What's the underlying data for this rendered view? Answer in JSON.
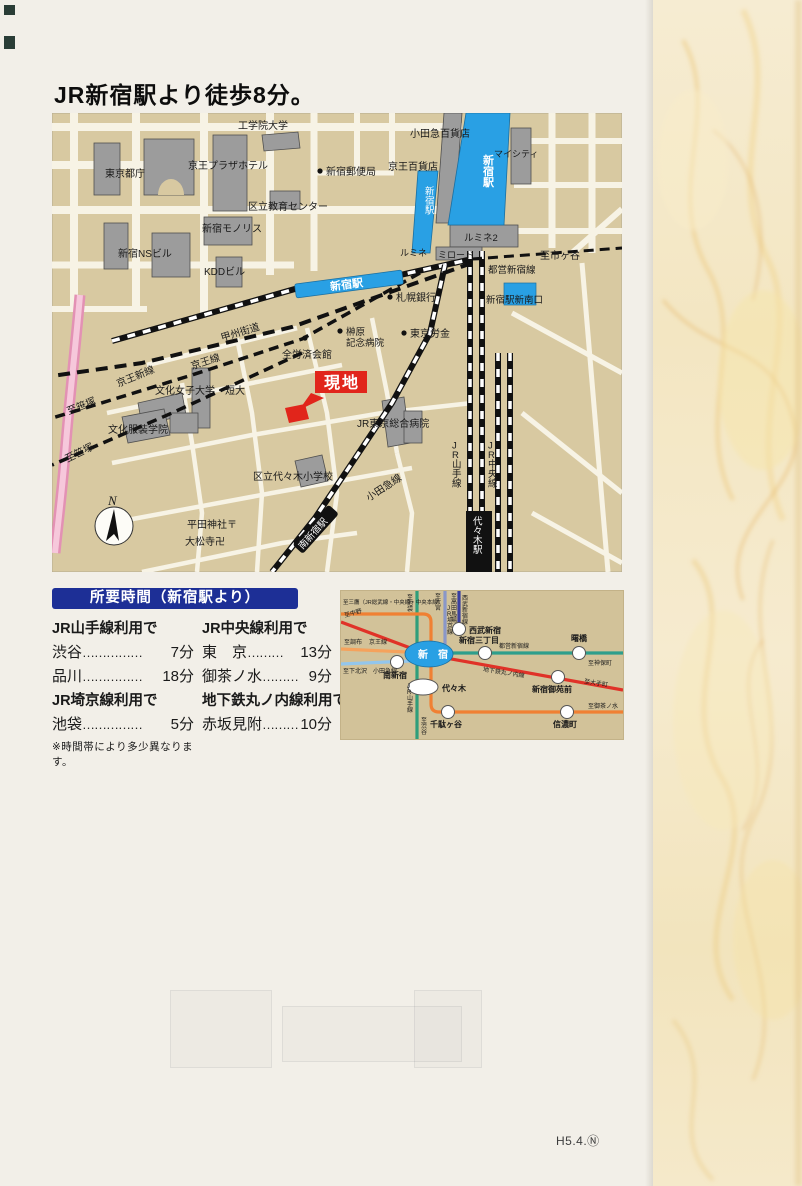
{
  "page": {
    "title": "JR新宿駅より徒歩8分。",
    "page_number": "H5.4.Ⓝ"
  },
  "colors": {
    "station_blue": "#29A0E4",
    "site_red": "#E1251B",
    "table_header_blue": "#1D2F96",
    "map_tan": "#D8C9A1",
    "washi_cream": "#F4E9C9"
  },
  "map": {
    "labels": {
      "kogakuin": "工学院大学",
      "odakyu_dept": "小田急百貨店",
      "mycity": "マイシティ",
      "tocho": "東京都庁",
      "keio_plaza": "京王プラザホテル",
      "post_office": "新宿郵便局",
      "keio_dept": "京王百貨店",
      "shinjuku_sta_east": "新宿駅",
      "shinjuku_sta_west": "新宿駅",
      "edu_center": "区立教育センター",
      "monolith": "新宿モノリス",
      "ns_bldg": "新宿NSビル",
      "kdd": "KDDビル",
      "lumine2": "ルミネ2",
      "lumine": "ルミネ",
      "mylord": "ミロード",
      "to_ichigaya": "至市ヶ谷",
      "toei_line": "都営新宿線",
      "platform": "新宿駅",
      "sapporo_bank": "札幌銀行",
      "new_south_exit": "新宿駅新南口",
      "koshu_kaido": "甲州街道",
      "sakakibara1": "榊原",
      "sakakibara2": "記念病院",
      "tokyo_rokin": "東京労金",
      "zenrosai": "全労済会館",
      "keio_line": "京王線",
      "keio_new_line": "京王新線",
      "to_sasazuka1": "至笹塚",
      "to_sasazuka2": "至笹塚",
      "bunka_univ": "文化女子大学・短大",
      "genchi": "現地",
      "bunka_fashion": "文化服装学院",
      "jr_hospital": "JR東京総合病院",
      "yoyogi_elem": "区立代々木小学校",
      "odakyu_line": "小田急線",
      "jr_yamanote": "JR山手線",
      "jr_chuo": "JR中央線",
      "compass_n": "N",
      "minami_shinjuku_sta": "南新宿駅",
      "hirata_shrine": "平田神社〒",
      "daimatsu_temple": "大松寺卍",
      "yoyogi_sta": "代々木駅"
    }
  },
  "access": {
    "header": "所要時間（新宿駅より）",
    "left": {
      "group1": "JR山手線利用で",
      "rows1": [
        {
          "name": "渋谷",
          "dots": "……………",
          "time": "7分"
        },
        {
          "name": "品川",
          "dots": "……………",
          "time": "18分"
        }
      ],
      "group2": "JR埼京線利用で",
      "rows2": [
        {
          "name": "池袋",
          "dots": "……………",
          "time": "5分"
        }
      ]
    },
    "right": {
      "group1": "JR中央線利用で",
      "rows1": [
        {
          "name": "東　京",
          "dots": "………",
          "time": "13分"
        },
        {
          "name": "御茶ノ水",
          "dots": "………",
          "time": "9分"
        }
      ],
      "group2": "地下鉄丸ノ内線利用で",
      "rows2": [
        {
          "name": "赤坂見附",
          "dots": "………",
          "time": "10分"
        }
      ]
    },
    "note": "※時間帯により多少異なります。"
  },
  "railmap": {
    "labels": {
      "shinjuku": "新　宿",
      "seibu_shinjuku": "西武新宿",
      "shinjuku_sanchome": "新宿三丁目",
      "akebonobashi": "曙橋",
      "minami_shinjuku": "南新宿",
      "yoyogi": "代々木",
      "gyoemmae": "新宿御苑前",
      "sendagaya": "千駄ヶ谷",
      "shinanomachi": "信濃町",
      "to_mitaka": "至三鷹（JR総武線・中央線・中央本線）",
      "to_nakano": "至中野",
      "to_chofu": "至調布",
      "keio_line": "京王線",
      "to_shimokitazawa": "至下北沢",
      "odakyu_line": "小田急線",
      "to_ikebukuro": "至池袋",
      "to_omiya": "至大宮",
      "jr_saikyo": "JR埼京線",
      "to_takadanobaba": "至高田馬場",
      "seibu_line": "西武新宿線",
      "toei_line": "都営新宿線",
      "to_jimbocho": "至神保町",
      "marunouchi": "地下鉄丸ノ内線",
      "to_otemachi": "至大手町",
      "jr_yamanote": "JR山手線",
      "to_shibuya": "至渋谷",
      "to_ochanomizu": "至御茶ノ水"
    }
  }
}
